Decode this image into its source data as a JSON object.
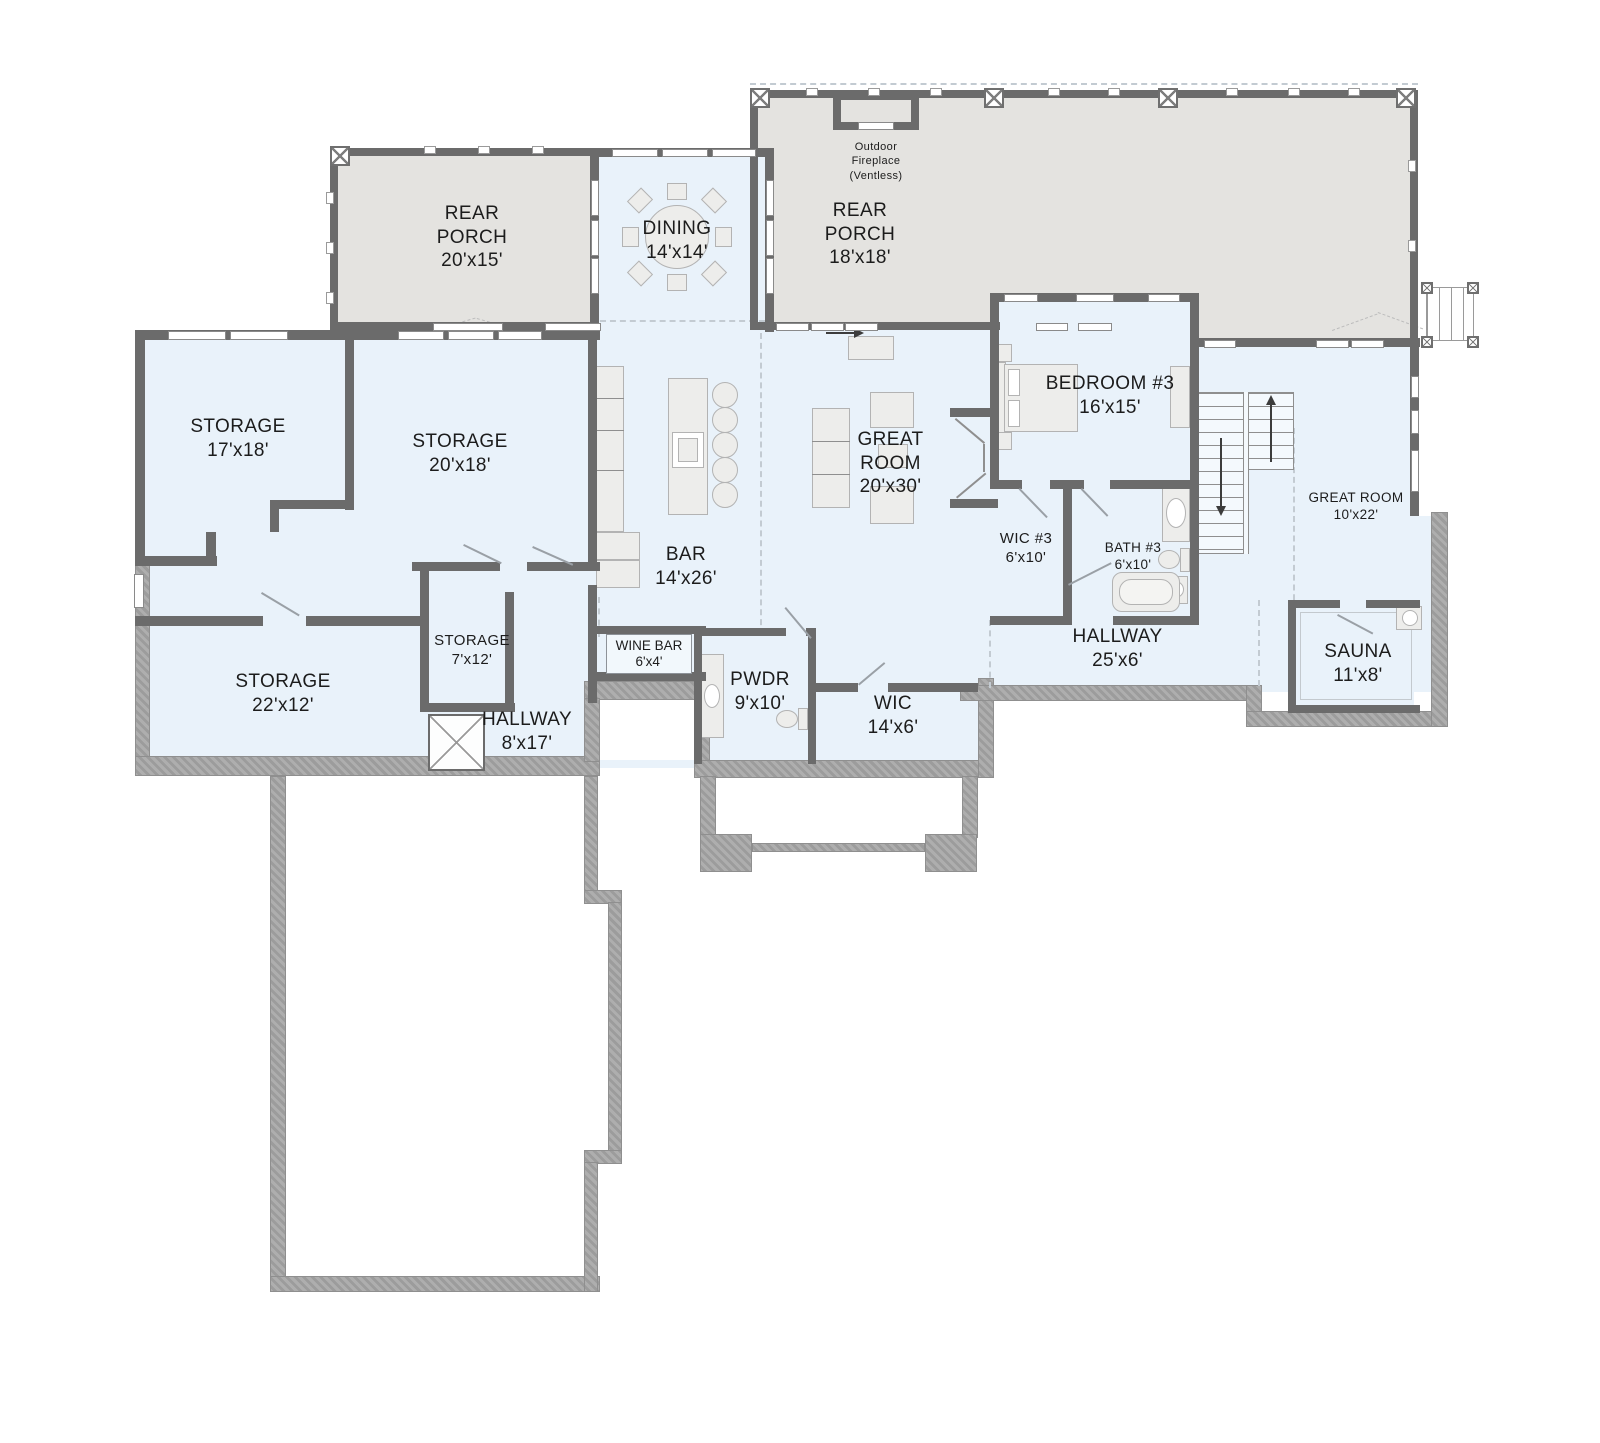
{
  "colors": {
    "wall": "#6b6b6b",
    "room_fill": "#e9f2fa",
    "porch_fill": "#e4e3e0",
    "foundation": "#9c9c9c",
    "furniture_fill": "#ededeb",
    "furniture_border": "#b3b3b3",
    "text": "#1c1c1c"
  },
  "rooms": {
    "rear_porch_left": {
      "name": "REAR PORCH",
      "dims": "20'x15'"
    },
    "dining": {
      "name": "DINING",
      "dims": "14'x14'"
    },
    "rear_porch_right": {
      "name": "REAR PORCH",
      "dims": "18'x18'"
    },
    "outdoor_fireplace": {
      "name": "Outdoor Fireplace",
      "note": "(Ventless)"
    },
    "storage_17x18": {
      "name": "STORAGE",
      "dims": "17'x18'"
    },
    "storage_20x18": {
      "name": "STORAGE",
      "dims": "20'x18'"
    },
    "bedroom_3": {
      "name": "BEDROOM #3",
      "dims": "16'x15'"
    },
    "great_room_main": {
      "name": "GREAT ROOM",
      "dims": "20'x30'"
    },
    "bar": {
      "name": "BAR",
      "dims": "14'x26'"
    },
    "wic_3": {
      "name": "WIC #3",
      "dims": "6'x10'"
    },
    "bath_3": {
      "name": "BATH #3",
      "dims": "6'x10'"
    },
    "great_room_upper": {
      "name": "GREAT ROOM",
      "dims": "10'x22'"
    },
    "storage_22x12": {
      "name": "STORAGE",
      "dims": "22'x12'"
    },
    "storage_7x12": {
      "name": "STORAGE",
      "dims": "7'x12'"
    },
    "hallway_8x17": {
      "name": "HALLWAY",
      "dims": "8'x17'"
    },
    "wine_bar": {
      "name": "WINE BAR",
      "dims": "6'x4'"
    },
    "pwdr": {
      "name": "PWDR",
      "dims": "9'x10'"
    },
    "wic": {
      "name": "WIC",
      "dims": "14'x6'"
    },
    "hallway_25x6": {
      "name": "HALLWAY",
      "dims": "25'x6'"
    },
    "sauna": {
      "name": "SAUNA",
      "dims": "11'x8'"
    }
  }
}
